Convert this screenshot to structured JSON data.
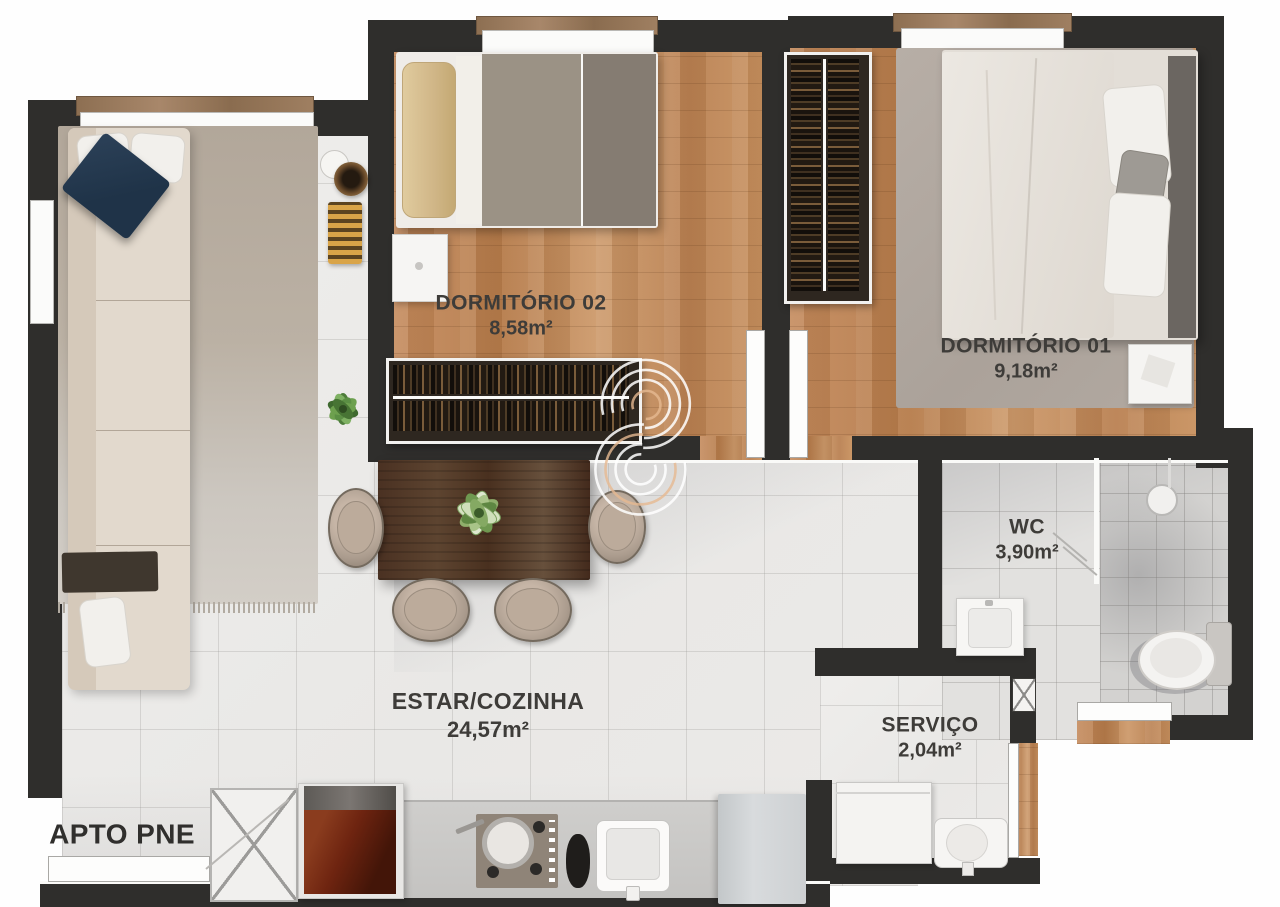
{
  "plan": {
    "unit_label": "APTO PNE",
    "rooms": [
      {
        "id": "dormitorio-02",
        "name": "DORMITÓRIO 02",
        "area": "8,58m²"
      },
      {
        "id": "dormitorio-01",
        "name": "DORMITÓRIO 01",
        "area": "9,18m²"
      },
      {
        "id": "wc",
        "name": "WC",
        "area": "3,90m²"
      },
      {
        "id": "servico",
        "name": "SERVIÇO",
        "area": "2,04m²"
      },
      {
        "id": "estar-cozinha",
        "name": "ESTAR/COZINHA",
        "area": "24,57m²"
      }
    ],
    "watermark_icon": "concentric-arcs-logo",
    "colors": {
      "wall": "#2f2e2c",
      "wood_floor": "#c0875a",
      "tile_floor": "#edecea",
      "label_text": "#3e3c39",
      "accent_pillow": "#263a4f",
      "stove": "#6e2410",
      "watermark": "#ffffff"
    }
  }
}
